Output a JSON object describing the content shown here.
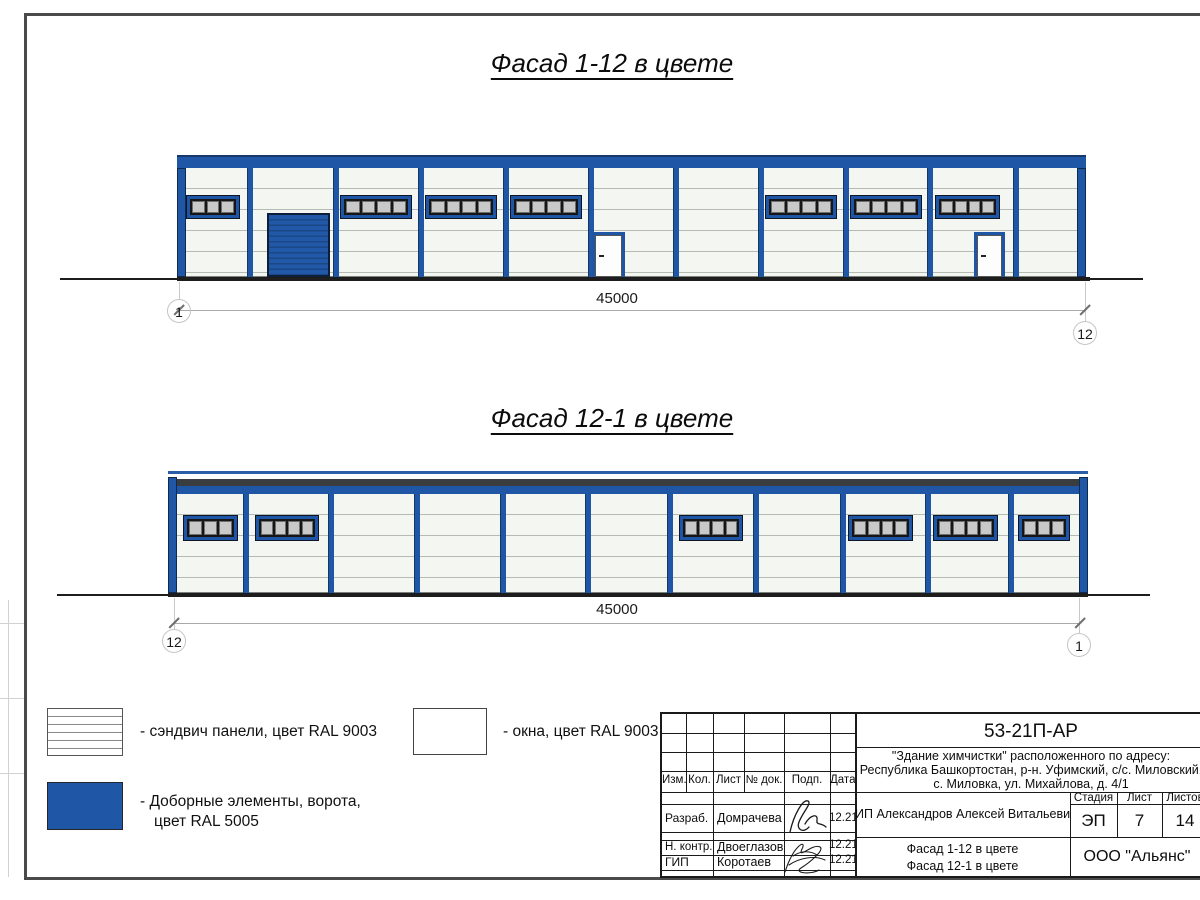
{
  "titles": {
    "facade1": "Фасад 1-12 в цвете",
    "facade2": "Фасад 12-1 в цвете"
  },
  "dimensions": {
    "facade1": {
      "length": "45000",
      "axis_left": "1",
      "axis_right": "12"
    },
    "facade2": {
      "length": "45000",
      "axis_left": "12",
      "axis_right": "1"
    }
  },
  "legend": {
    "items": [
      {
        "swatch": "sandwich-panels",
        "label": "- сэндвич панели, цвет RAL 9003"
      },
      {
        "swatch": "windows",
        "label": "- окна, цвет RAL 9003"
      },
      {
        "swatch": "blue-elements",
        "line1": "- Доборные элементы, ворота,",
        "line2": "цвет RAL 5005"
      }
    ]
  },
  "title_block": {
    "doc_number": "53-21П-АР",
    "address_line1": "\"Здание химчистки\" расположенного по адресу:",
    "address_line2": "Республика Башкортостан, р-н. Уфимский, с/с. Миловский,",
    "address_line3": "с. Миловка, ул. Михайлова, д. 4/1",
    "columns": {
      "izm": "Изм.",
      "kol": "Кол.",
      "list": "Лист",
      "doc": "№ док.",
      "podp": "Подп.",
      "data": "Дата"
    },
    "staff": [
      {
        "role": "Разраб.",
        "name": "Домрачева",
        "date": "12.21"
      },
      {
        "role": "Н. контр.",
        "name": "Двоеглазов",
        "date": "12.21"
      },
      {
        "role": "ГИП",
        "name": "Коротаев",
        "date": "12.21"
      }
    ],
    "client": "ИП Александров Алексей Витальевич",
    "sheet_title_line1": "Фасад 1-12 в цвете",
    "sheet_title_line2": "Фасад 12-1 в цвете",
    "stage_label": "Стадия",
    "stage": "ЭП",
    "sheet_label": "Лист",
    "sheet_no": "7",
    "sheets_label": "Листов",
    "sheets_total": "14",
    "company": "ООО \"Альянс\""
  },
  "colors": {
    "blue_ral5005": "#2056a6",
    "dark_frame": "#0e1d38",
    "wall_ral9003": "#f3f6f1",
    "pane_glass": "#c9c9c9",
    "ground": "#1d1d1d",
    "roof_dark_band": "#3a3d40"
  },
  "drawing": {
    "facade1": {
      "left": 177,
      "top": 155,
      "width": 909,
      "height": 122,
      "bands": [
        {
          "y": 0,
          "h": 2,
          "c": "#16396b"
        },
        {
          "y": 2,
          "h": 11,
          "c": "#2056a6"
        }
      ],
      "wallY": 13,
      "edgeY": 13,
      "columns": [
        70,
        156,
        241,
        326,
        411,
        496,
        581,
        666,
        750,
        836
      ],
      "winY": 40,
      "winH": 24,
      "windows": [
        {
          "x": 9,
          "w": 54,
          "p": 3
        },
        {
          "x": 163,
          "w": 72,
          "p": 4
        },
        {
          "x": 248,
          "w": 72,
          "p": 4
        },
        {
          "x": 333,
          "w": 72,
          "p": 4
        },
        {
          "x": 588,
          "w": 72,
          "p": 4
        },
        {
          "x": 673,
          "w": 72,
          "p": 4
        },
        {
          "x": 758,
          "w": 65,
          "p": 4
        }
      ],
      "gate": {
        "x": 90,
        "y": 58,
        "w": 63
      },
      "doorY": 77,
      "doors": [
        {
          "x": 415,
          "w": 33
        },
        {
          "x": 797,
          "w": 31
        }
      ]
    },
    "facade2": {
      "left": 168,
      "top": 471,
      "width": 920,
      "height": 122,
      "bands": [
        {
          "y": 0,
          "h": 2.5,
          "c": "#2a5fa8"
        },
        {
          "y": 8,
          "h": 7,
          "c": "#3a3d40"
        },
        {
          "y": 15,
          "h": 8,
          "c": "#2056a6"
        }
      ],
      "wallY": 23,
      "edgeY": 6,
      "columns": [
        75,
        160,
        246,
        332,
        417,
        499,
        585,
        672,
        757,
        840
      ],
      "winY": 44,
      "winH": 26,
      "windows": [
        {
          "x": 15,
          "w": 55,
          "p": 3
        },
        {
          "x": 87,
          "w": 64,
          "p": 4
        },
        {
          "x": 511,
          "w": 64,
          "p": 4
        },
        {
          "x": 680,
          "w": 65,
          "p": 4
        },
        {
          "x": 765,
          "w": 65,
          "p": 4
        },
        {
          "x": 850,
          "w": 52,
          "p": 3
        }
      ],
      "doors": []
    }
  }
}
